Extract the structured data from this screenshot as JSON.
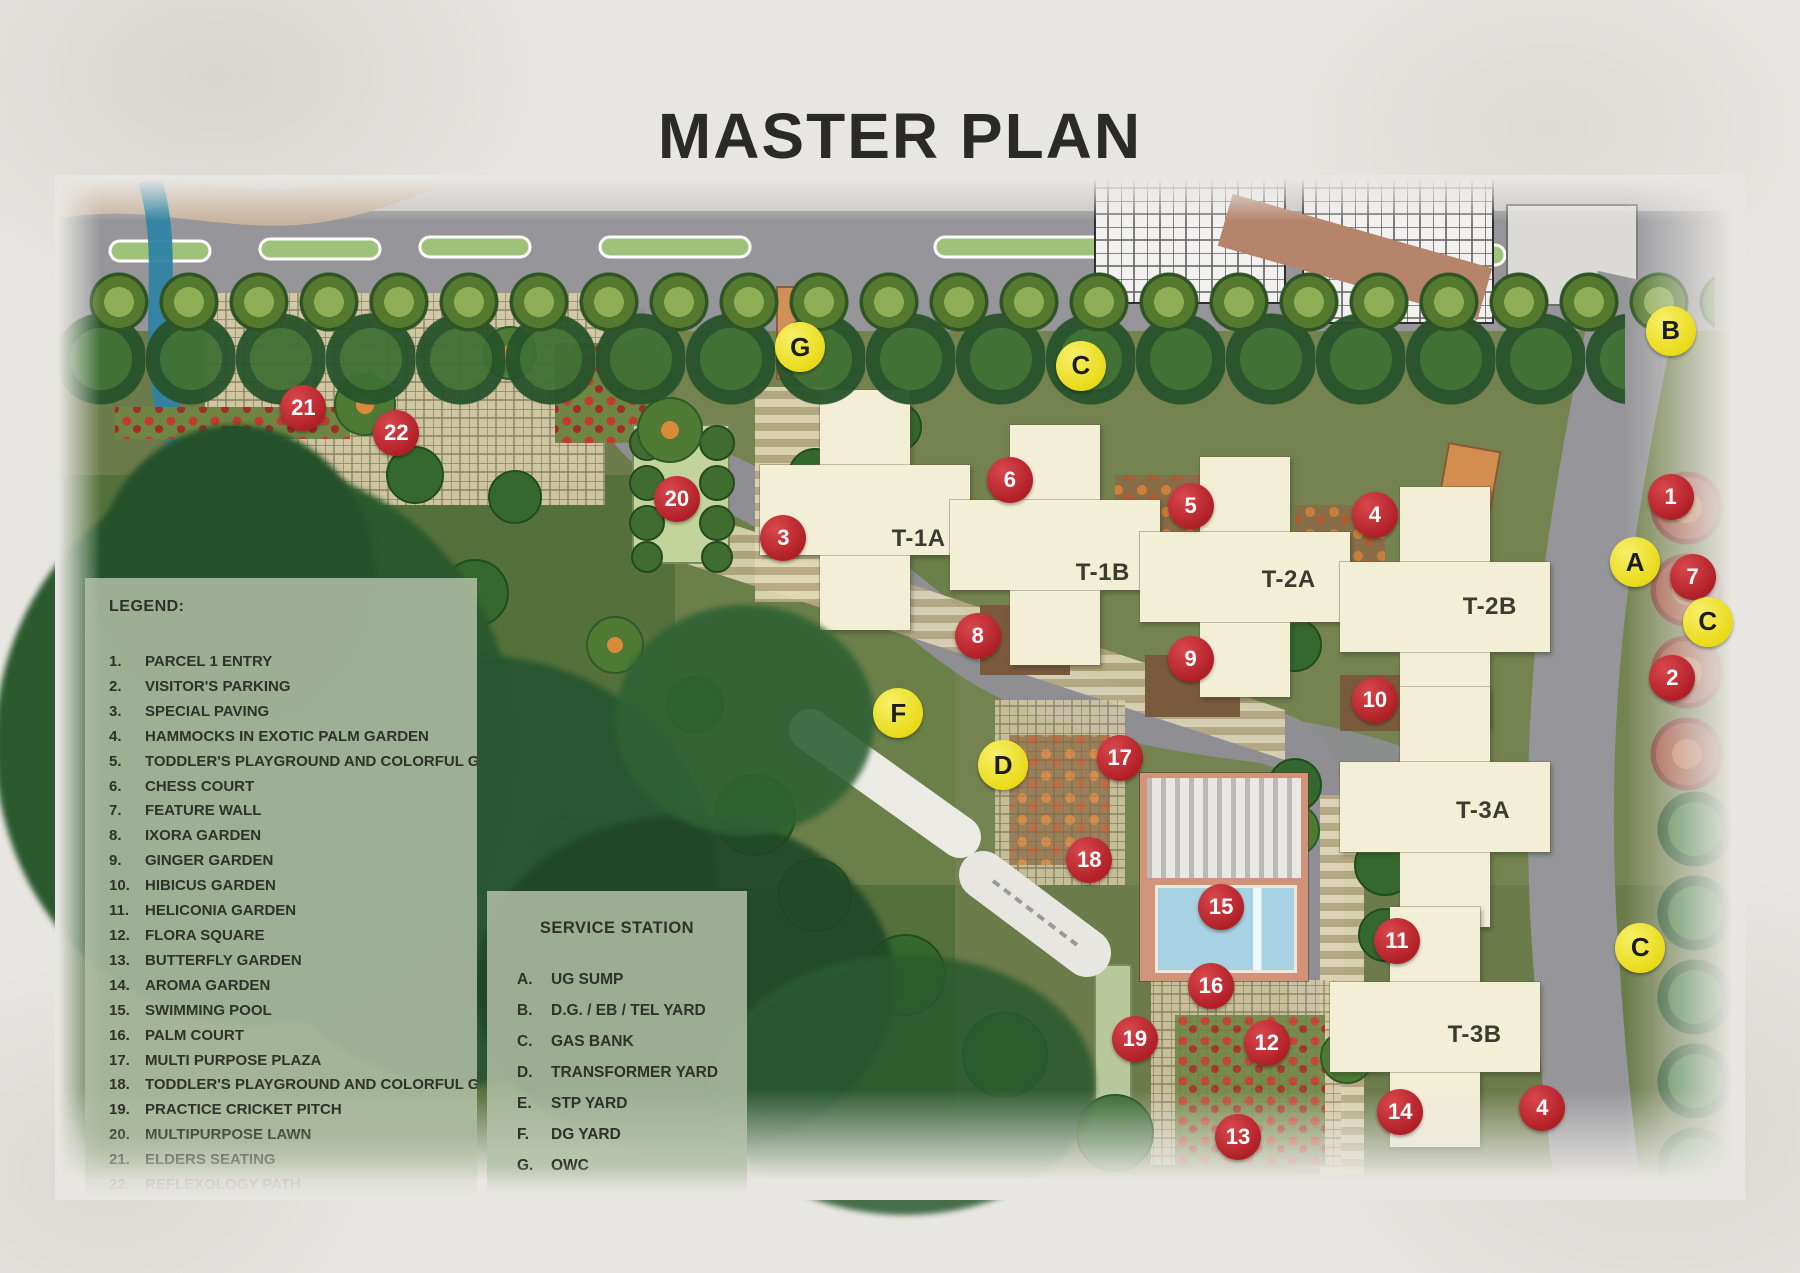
{
  "title": "MASTER PLAN",
  "legend": {
    "heading": "LEGEND:",
    "items": [
      {
        "num": "1.",
        "label": "PARCEL 1 ENTRY"
      },
      {
        "num": "2.",
        "label": "VISITOR'S PARKING"
      },
      {
        "num": "3.",
        "label": "SPECIAL PAVING"
      },
      {
        "num": "4.",
        "label": "HAMMOCKS IN EXOTIC PALM GARDEN"
      },
      {
        "num": "5.",
        "label": "TODDLER'S PLAYGROUND AND COLORFUL GARDEN"
      },
      {
        "num": "6.",
        "label": "CHESS COURT"
      },
      {
        "num": "7.",
        "label": "FEATURE WALL"
      },
      {
        "num": "8.",
        "label": "IXORA GARDEN"
      },
      {
        "num": "9.",
        "label": "GINGER GARDEN"
      },
      {
        "num": "10.",
        "label": "HIBICUS GARDEN"
      },
      {
        "num": "11.",
        "label": "HELICONIA GARDEN"
      },
      {
        "num": "12.",
        "label": "FLORA SQUARE"
      },
      {
        "num": "13.",
        "label": "BUTTERFLY GARDEN"
      },
      {
        "num": "14.",
        "label": "AROMA GARDEN"
      },
      {
        "num": "15.",
        "label": "SWIMMING POOL"
      },
      {
        "num": "16.",
        "label": "PALM COURT"
      },
      {
        "num": "17.",
        "label": "MULTI PURPOSE PLAZA"
      },
      {
        "num": "18.",
        "label": "TODDLER'S PLAYGROUND AND COLORFUL GARDEN"
      },
      {
        "num": "19.",
        "label": "PRACTICE CRICKET PITCH"
      },
      {
        "num": "20.",
        "label": "MULTIPURPOSE LAWN"
      },
      {
        "num": "21.",
        "label": "ELDERS SEATING"
      },
      {
        "num": "22.",
        "label": "REFLEXOLOGY PATH",
        "muted": true
      }
    ]
  },
  "service_station": {
    "heading": "SERVICE STATION",
    "items": [
      {
        "key": "A.",
        "label": "UG SUMP"
      },
      {
        "key": "B.",
        "label": "D.G. / EB / TEL YARD"
      },
      {
        "key": "C.",
        "label": "GAS BANK"
      },
      {
        "key": "D.",
        "label": "TRANSFORMER YARD"
      },
      {
        "key": "E.",
        "label": "STP YARD"
      },
      {
        "key": "F.",
        "label": "DG YARD"
      },
      {
        "key": "G.",
        "label": "OWC"
      }
    ]
  },
  "map": {
    "towers": [
      {
        "label": "T-1A",
        "x": 51.1,
        "y": 35.5
      },
      {
        "label": "T-1B",
        "x": 62.0,
        "y": 38.8
      },
      {
        "label": "T-2A",
        "x": 73.0,
        "y": 39.5
      },
      {
        "label": "T-2B",
        "x": 84.9,
        "y": 42.1
      },
      {
        "label": "T-3A",
        "x": 84.5,
        "y": 62.0
      },
      {
        "label": "T-3B",
        "x": 84.0,
        "y": 83.9
      }
    ],
    "markers_red": [
      {
        "label": "1",
        "x": 95.6,
        "y": 31.4
      },
      {
        "label": "2",
        "x": 95.7,
        "y": 49.1
      },
      {
        "label": "3",
        "x": 43.1,
        "y": 35.4
      },
      {
        "label": "4",
        "x": 78.1,
        "y": 33.2
      },
      {
        "label": "4",
        "x": 88.0,
        "y": 91.0
      },
      {
        "label": "5",
        "x": 67.2,
        "y": 32.3
      },
      {
        "label": "6",
        "x": 56.5,
        "y": 29.8
      },
      {
        "label": "7",
        "x": 96.9,
        "y": 39.2
      },
      {
        "label": "8",
        "x": 54.6,
        "y": 45.0
      },
      {
        "label": "9",
        "x": 67.2,
        "y": 47.2
      },
      {
        "label": "10",
        "x": 78.1,
        "y": 51.2
      },
      {
        "label": "11",
        "x": 79.4,
        "y": 74.7
      },
      {
        "label": "12",
        "x": 71.7,
        "y": 84.7
      },
      {
        "label": "13",
        "x": 70.0,
        "y": 93.9
      },
      {
        "label": "14",
        "x": 79.6,
        "y": 91.4
      },
      {
        "label": "15",
        "x": 69.0,
        "y": 71.4
      },
      {
        "label": "16",
        "x": 68.4,
        "y": 79.1
      },
      {
        "label": "17",
        "x": 63.0,
        "y": 56.9
      },
      {
        "label": "18",
        "x": 61.2,
        "y": 66.8
      },
      {
        "label": "19",
        "x": 63.9,
        "y": 84.3
      },
      {
        "label": "20",
        "x": 36.8,
        "y": 31.6
      },
      {
        "label": "21",
        "x": 14.7,
        "y": 22.7
      },
      {
        "label": "22",
        "x": 20.2,
        "y": 25.2
      }
    ],
    "markers_yellow": [
      {
        "label": "G",
        "x": 44.1,
        "y": 16.8
      },
      {
        "label": "C",
        "x": 60.7,
        "y": 18.6
      },
      {
        "label": "B",
        "x": 95.6,
        "y": 15.2
      },
      {
        "label": "A",
        "x": 93.5,
        "y": 37.8
      },
      {
        "label": "C",
        "x": 97.8,
        "y": 43.6
      },
      {
        "label": "F",
        "x": 49.9,
        "y": 52.5
      },
      {
        "label": "D",
        "x": 56.1,
        "y": 57.6
      },
      {
        "label": "C",
        "x": 93.8,
        "y": 75.4
      }
    ]
  },
  "colors": {
    "title_text": "#2a2a28",
    "marker_red": "#c1272d",
    "marker_yellow": "#f2e424",
    "tower_cream": "#f3eed6",
    "road_gray": "#96969a",
    "forest_green": "#2b5a2e",
    "lawn_olive": "#55713b",
    "pool_water": "#a6d2e3",
    "pool_deck": "#d2937b",
    "panel_sage": "#b7c2ab",
    "paving_tan": "#d8cba6",
    "stream_blue": "#2f83a3"
  }
}
